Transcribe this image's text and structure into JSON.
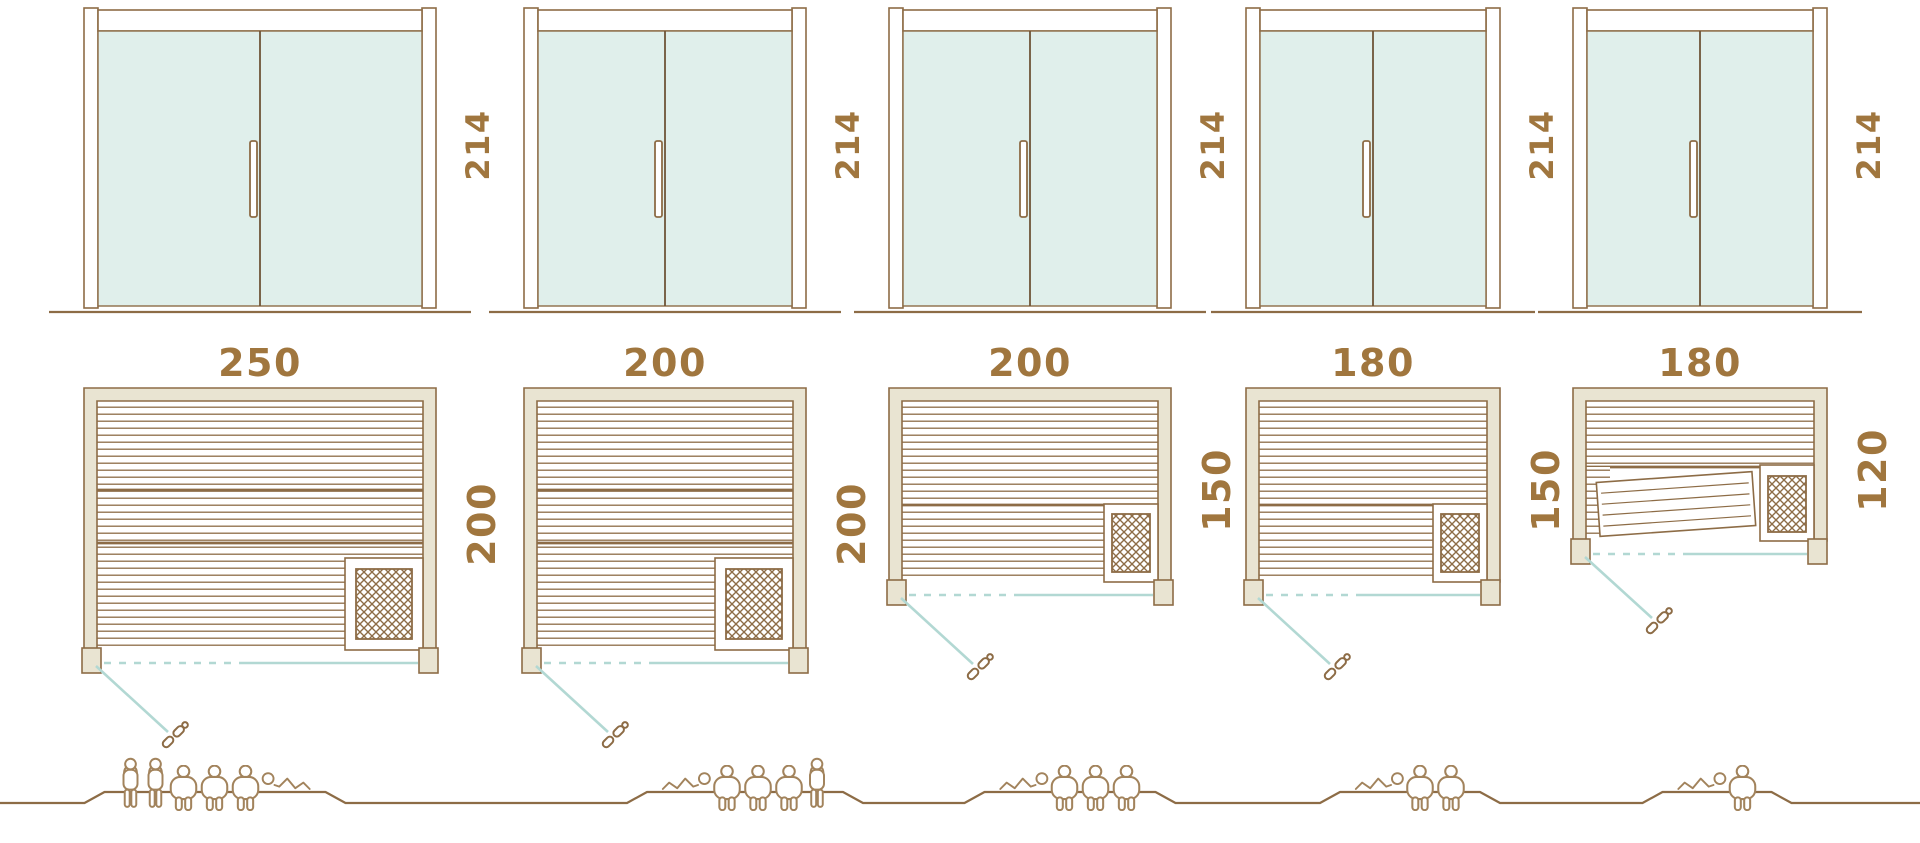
{
  "colors": {
    "line_brown": "#8d6c46",
    "label_brown": "#a0763e",
    "wall_beige": "#e9e4d2",
    "glass_mint": "#e0efeb",
    "swing_teal": "#b2d8d3",
    "figure_brown": "#a2835c"
  },
  "saunas": [
    {
      "door_height_cm": "214",
      "width_cm": "250",
      "depth_cm": "200",
      "capacity": 6,
      "people": [
        "standing",
        "standing",
        "seated",
        "seated",
        "seated",
        "reclining-head-left"
      ]
    },
    {
      "door_height_cm": "214",
      "width_cm": "200",
      "depth_cm": "200",
      "capacity": 5,
      "people": [
        "reclining-head-right",
        "seated",
        "seated",
        "seated",
        "standing"
      ]
    },
    {
      "door_height_cm": "214",
      "width_cm": "200",
      "depth_cm": "150",
      "capacity": 4,
      "people": [
        "reclining-head-right",
        "seated",
        "seated",
        "seated"
      ]
    },
    {
      "door_height_cm": "214",
      "width_cm": "180",
      "depth_cm": "150",
      "capacity": 3,
      "people": [
        "reclining-head-right",
        "seated",
        "seated"
      ]
    },
    {
      "door_height_cm": "214",
      "width_cm": "180",
      "depth_cm": "120",
      "capacity": 2,
      "people": [
        "reclining-head-right",
        "seated"
      ]
    }
  ]
}
